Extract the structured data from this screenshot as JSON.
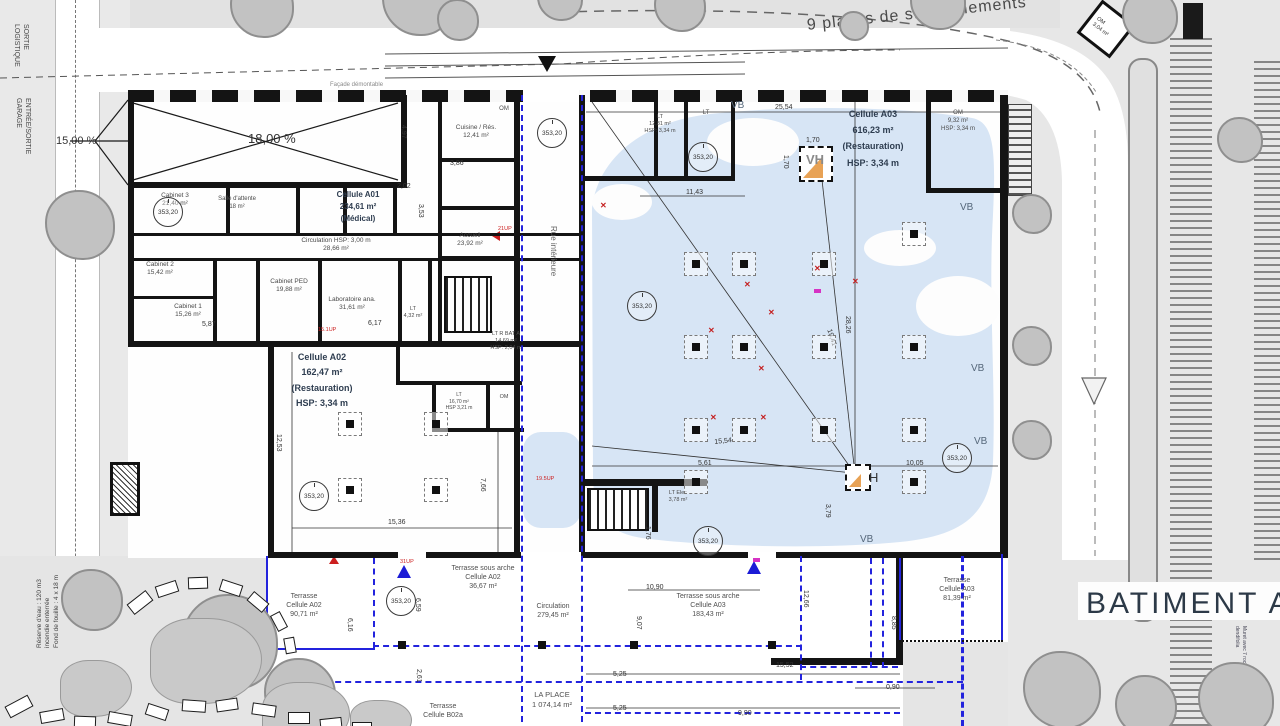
{
  "colors": {
    "water": "#d7e5f5",
    "blue_line": "#2323dd",
    "wall": "#141414",
    "cell_label": "#2e3d50",
    "room_label": "#4a4a4a",
    "red": "#cc1f1f",
    "magenta": "#d633c4",
    "orange": "#e8a255"
  },
  "labels": [
    {
      "n": "batiment-a-title",
      "t": "BATIMENT A",
      "x": 1086,
      "y": 584,
      "fs": 30,
      "col": "#2c3947",
      "ls": 3
    },
    {
      "n": "parking-label",
      "t": "9 places de stationnements",
      "x": 806,
      "y": 16,
      "fs": 16,
      "col": "#4a4a4a",
      "rot": -6,
      "ls": 1
    },
    {
      "n": "facade-demontable",
      "t": "Façade démontable",
      "x": 330,
      "y": 82,
      "fs": 6,
      "col": "#8a8a8a"
    },
    {
      "n": "rue-interieure",
      "t": "Rue intérieure",
      "x": 558,
      "y": 226,
      "fs": 8,
      "col": "#666",
      "rot": 90
    },
    {
      "n": "ramp-main",
      "t": "18,00 %",
      "x": 248,
      "y": 131,
      "fs": 13,
      "col": "#333"
    },
    {
      "n": "ramp-side",
      "t": "15,00 %",
      "x": 56,
      "y": 134,
      "fs": 11,
      "col": "#333"
    },
    {
      "n": "sortie-logistique",
      "t": "SORTIE\nLOGISTIQUE",
      "x": 30,
      "y": 24,
      "fs": 7,
      "col": "#444",
      "rot": 90
    },
    {
      "n": "entree-sortie-garage",
      "t": "ENTRÉE/SORTIE\nGARAGE",
      "x": 32,
      "y": 98,
      "fs": 7,
      "col": "#444",
      "rot": 90
    },
    {
      "n": "reserve-eau",
      "t": "Réserve d'eau : 120 m3\nincendie enterrée\nFond de fouille : 4 x 18 m",
      "x": 36,
      "y": 648,
      "fs": 6.5,
      "col": "#444",
      "rot": -90
    },
    {
      "n": "muret-note",
      "t": "Muret avec 7 roches\ndendifolia",
      "x": 1247,
      "y": 626,
      "fs": 5,
      "col": "#445",
      "rot": 90
    },
    {
      "n": "om-diamond-label",
      "t": "OM\n3,04 m²",
      "x": 1099,
      "y": 16,
      "fs": 5.5,
      "col": "#333",
      "rot": 38
    },
    {
      "n": "vh-top-label",
      "t": "VH",
      "x": 806,
      "y": 152,
      "fs": 13,
      "col": "#8a8a8a",
      "b": 1
    },
    {
      "n": "vh-bottom-label",
      "t": "H",
      "x": 869,
      "y": 470,
      "fs": 13,
      "col": "#333"
    }
  ],
  "cells": [
    {
      "n": "cellule-a01",
      "t": "Cellule A01\n234,61 m²\n(Médical)",
      "x": 358,
      "y": 189,
      "fs": 8,
      "lh": 1.5
    },
    {
      "n": "cellule-a02",
      "t": "Cellule A02\n162,47 m²\n(Restauration)\nHSP: 3,34 m",
      "x": 322,
      "y": 350,
      "fs": 9,
      "lh": 1.7
    },
    {
      "n": "cellule-a03",
      "t": "Cellule A03\n616,23 m²\n(Restauration)\nHSP: 3,34 m",
      "x": 873,
      "y": 106,
      "fs": 9,
      "lh": 1.8
    }
  ],
  "rooms": [
    {
      "t": "Cabinet 3\n21,40 m²",
      "x": 175,
      "y": 192,
      "fs": 6.5
    },
    {
      "t": "Salle d'attente\n18 m²",
      "x": 237,
      "y": 196,
      "fs": 6
    },
    {
      "t": "Circulation HSP: 3,00 m\n28,66 m²",
      "x": 336,
      "y": 237,
      "fs": 6.5
    },
    {
      "t": "Cabinet 2\n15,42 m²",
      "x": 160,
      "y": 261,
      "fs": 6.5
    },
    {
      "t": "Cabinet 1\n15,26 m²",
      "x": 188,
      "y": 303,
      "fs": 6.5
    },
    {
      "t": "Cabinet PED\n19,88 m²",
      "x": 289,
      "y": 278,
      "fs": 6.5
    },
    {
      "t": "Laboratoire ana.\n31,61 m²",
      "x": 352,
      "y": 296,
      "fs": 6.5
    },
    {
      "t": "LT\n4,32 m²",
      "x": 413,
      "y": 306,
      "fs": 5.5
    },
    {
      "t": "Cuisine / Rés.\n12,41 m²",
      "x": 476,
      "y": 124,
      "fs": 6.5
    },
    {
      "t": "OM",
      "x": 504,
      "y": 106,
      "fs": 6
    },
    {
      "t": "Accueil\n23,92 m²",
      "x": 470,
      "y": 232,
      "fs": 6.5
    },
    {
      "t": "LT\n12,81 m²\nHSP: 3,34 m",
      "x": 660,
      "y": 114,
      "fs": 5.5
    },
    {
      "t": "LT",
      "x": 706,
      "y": 110,
      "fs": 6
    },
    {
      "t": "OM\n9,32 m²\nHSP: 3,34 m",
      "x": 958,
      "y": 110,
      "fs": 6
    },
    {
      "t": "LT R BAT A\n14,69 m²\nHSP: 2,04 m",
      "x": 506,
      "y": 331,
      "fs": 5.5
    },
    {
      "t": "LT\n16,70 m²\nHSP 3,21 m",
      "x": 459,
      "y": 392,
      "fs": 5
    },
    {
      "t": "OM",
      "x": 504,
      "y": 394,
      "fs": 5.5
    },
    {
      "t": "LT Elec\n3,78 m²",
      "x": 678,
      "y": 490,
      "fs": 5.5
    }
  ],
  "terraces": [
    {
      "t": "Terrasse\nCellule A02\n90,71 m²",
      "x": 304,
      "y": 592,
      "fs": 7
    },
    {
      "t": "Terrasse sous arche\nCellule A02\n36,67 m²",
      "x": 483,
      "y": 564,
      "fs": 7
    },
    {
      "t": "Circulation\n279,45 m²",
      "x": 553,
      "y": 602,
      "fs": 7
    },
    {
      "t": "Terrasse sous arche\nCellule A03\n183,43 m²",
      "x": 708,
      "y": 592,
      "fs": 7
    },
    {
      "t": "Terrasse\nCellule A03\n81,39 m²",
      "x": 957,
      "y": 576,
      "fs": 7
    },
    {
      "t": "LA PLACE\n1 074,14 m²",
      "x": 552,
      "y": 690,
      "fs": 7.5
    },
    {
      "t": "Terrasse\nCellule B02a",
      "x": 443,
      "y": 702,
      "fs": 7
    }
  ],
  "dims": [
    {
      "t": "25,54",
      "x": 775,
      "y": 103
    },
    {
      "t": "11,43",
      "x": 686,
      "y": 188
    },
    {
      "t": "28,26",
      "x": 852,
      "y": 316,
      "r": 90
    },
    {
      "t": "19,41",
      "x": 833,
      "y": 328,
      "r": 72
    },
    {
      "t": "15,54",
      "x": 714,
      "y": 438,
      "r": -6
    },
    {
      "t": "5,61",
      "x": 698,
      "y": 459
    },
    {
      "t": "10,05",
      "x": 906,
      "y": 459
    },
    {
      "t": "3,79",
      "x": 832,
      "y": 504,
      "r": 90
    },
    {
      "t": "1,76",
      "x": 652,
      "y": 526,
      "r": 90
    },
    {
      "t": "12,53",
      "x": 283,
      "y": 434,
      "r": 90
    },
    {
      "t": "15,36",
      "x": 388,
      "y": 518
    },
    {
      "t": "7,66",
      "x": 487,
      "y": 478,
      "r": 90
    },
    {
      "t": "4,97",
      "x": 408,
      "y": 125,
      "r": 90
    },
    {
      "t": "3,53",
      "x": 425,
      "y": 204,
      "r": 90
    },
    {
      "t": "2,02",
      "x": 397,
      "y": 182
    },
    {
      "t": "3,86",
      "x": 450,
      "y": 159
    },
    {
      "t": "5,87",
      "x": 202,
      "y": 320
    },
    {
      "t": "6,17",
      "x": 368,
      "y": 319
    },
    {
      "t": "6,16",
      "x": 354,
      "y": 618,
      "r": 90
    },
    {
      "t": "6,59",
      "x": 422,
      "y": 598,
      "r": 90
    },
    {
      "t": "2,61",
      "x": 423,
      "y": 669,
      "r": 90
    },
    {
      "t": "9,07",
      "x": 643,
      "y": 616,
      "r": 90
    },
    {
      "t": "10,90",
      "x": 646,
      "y": 583
    },
    {
      "t": "12,66",
      "x": 810,
      "y": 590,
      "r": 90
    },
    {
      "t": "8,85",
      "x": 898,
      "y": 616,
      "r": 90
    },
    {
      "t": "15,52",
      "x": 776,
      "y": 661
    },
    {
      "t": "5,25",
      "x": 613,
      "y": 670
    },
    {
      "t": "5,25",
      "x": 613,
      "y": 704
    },
    {
      "t": "9,90",
      "x": 738,
      "y": 709
    },
    {
      "t": "0,90",
      "x": 886,
      "y": 683
    },
    {
      "t": "1,70",
      "x": 806,
      "y": 136
    },
    {
      "t": "1,70",
      "x": 790,
      "y": 155,
      "r": 90
    }
  ],
  "levels": {
    "value": "353,20",
    "points": [
      [
        153,
        197
      ],
      [
        537,
        118
      ],
      [
        688,
        142
      ],
      [
        627,
        291
      ],
      [
        942,
        443
      ],
      [
        299,
        481
      ],
      [
        693,
        526
      ],
      [
        386,
        586
      ]
    ]
  },
  "vb": {
    "value": "VB",
    "points": [
      [
        731,
        99
      ],
      [
        960,
        201
      ],
      [
        971,
        362
      ],
      [
        974,
        435
      ],
      [
        860,
        533
      ]
    ]
  },
  "tags": [
    {
      "t": "21UP",
      "x": 498,
      "y": 226
    },
    {
      "t": "31UP",
      "x": 400,
      "y": 559
    },
    {
      "t": "15.1UP",
      "x": 318,
      "y": 327
    },
    {
      "t": "19.5UP",
      "x": 536,
      "y": 476
    }
  ],
  "columns": {
    "a03": [
      [
        684,
        252
      ],
      [
        732,
        252
      ],
      [
        812,
        252
      ],
      [
        902,
        222
      ],
      [
        684,
        335
      ],
      [
        732,
        335
      ],
      [
        812,
        335
      ],
      [
        902,
        335
      ],
      [
        684,
        418
      ],
      [
        732,
        418
      ],
      [
        812,
        418
      ],
      [
        902,
        418
      ],
      [
        684,
        470
      ],
      [
        902,
        470
      ]
    ],
    "a02": [
      [
        338,
        412
      ],
      [
        424,
        412
      ],
      [
        338,
        478
      ],
      [
        424,
        478
      ]
    ]
  },
  "crosses": [
    [
      744,
      280
    ],
    [
      768,
      308
    ],
    [
      814,
      264
    ],
    [
      708,
      326
    ],
    [
      758,
      364
    ],
    [
      710,
      413
    ],
    [
      760,
      413
    ],
    [
      852,
      277
    ],
    [
      600,
      201
    ]
  ],
  "magenta_marks": [
    [
      814,
      289
    ],
    [
      753,
      558
    ]
  ],
  "trees": [
    [
      262,
      6,
      64
    ],
    [
      418,
      0,
      72
    ],
    [
      458,
      20,
      42
    ],
    [
      560,
      -2,
      46
    ],
    [
      680,
      6,
      52
    ],
    [
      938,
      2,
      56
    ],
    [
      854,
      26,
      30
    ],
    [
      1150,
      16,
      56
    ],
    [
      80,
      225,
      70
    ],
    [
      1032,
      214,
      40
    ],
    [
      1032,
      346,
      40
    ],
    [
      1032,
      440,
      40
    ],
    [
      230,
      642,
      96
    ],
    [
      300,
      694,
      72
    ],
    [
      92,
      600,
      62
    ],
    [
      1062,
      690,
      78
    ],
    [
      1146,
      706,
      62
    ],
    [
      1236,
      700,
      76
    ],
    [
      1240,
      140,
      46
    ]
  ],
  "rocks": [
    [
      128,
      596,
      24,
      13,
      -38
    ],
    [
      156,
      583,
      22,
      12,
      -18
    ],
    [
      188,
      577,
      20,
      12,
      -2
    ],
    [
      220,
      582,
      22,
      12,
      18
    ],
    [
      248,
      596,
      20,
      12,
      40
    ],
    [
      270,
      616,
      18,
      11,
      62
    ],
    [
      282,
      640,
      16,
      11,
      80
    ],
    [
      6,
      700,
      26,
      13,
      -28
    ],
    [
      40,
      710,
      24,
      12,
      -10
    ],
    [
      74,
      716,
      22,
      12,
      2
    ],
    [
      108,
      713,
      24,
      12,
      10
    ],
    [
      146,
      706,
      22,
      12,
      18
    ],
    [
      182,
      700,
      24,
      12,
      4
    ],
    [
      216,
      699,
      22,
      12,
      -8
    ],
    [
      252,
      704,
      24,
      12,
      8
    ],
    [
      288,
      712,
      22,
      12,
      0
    ],
    [
      320,
      718,
      22,
      12,
      -6
    ],
    [
      352,
      722,
      20,
      11,
      0
    ]
  ],
  "boulders": [
    [
      150,
      618,
      110,
      84
    ],
    [
      262,
      682,
      86,
      64
    ],
    [
      60,
      660,
      70,
      55
    ],
    [
      350,
      700,
      60,
      40
    ]
  ]
}
